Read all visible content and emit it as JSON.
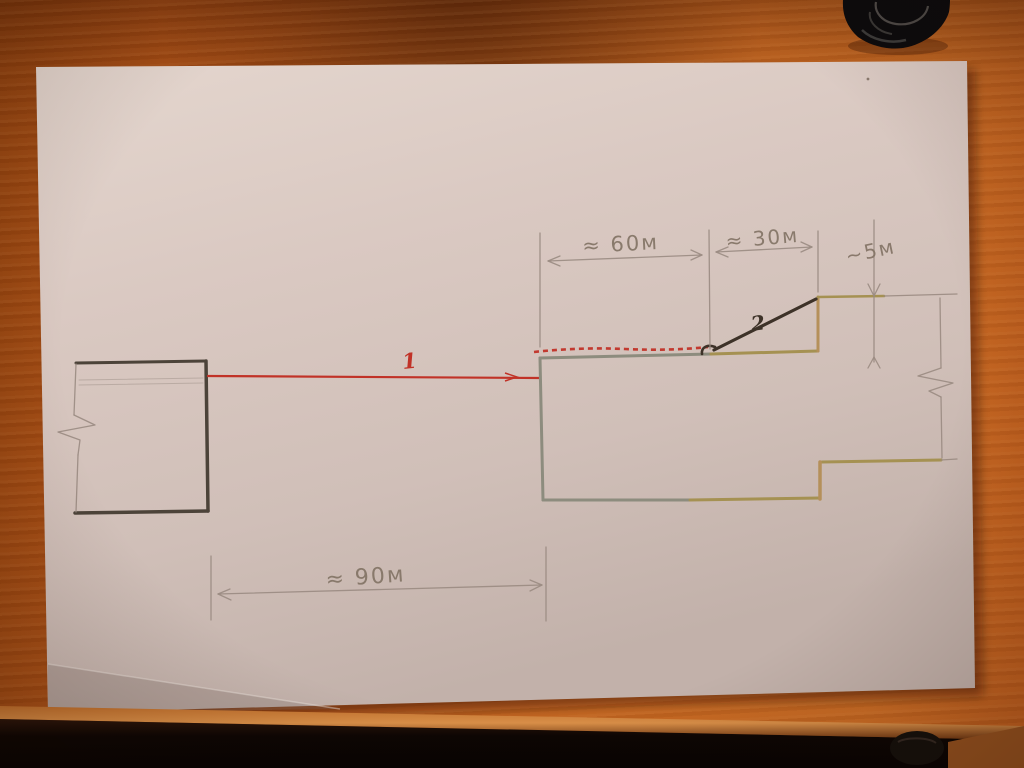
{
  "sketch": {
    "labels": {
      "line1": "1",
      "line2": "2"
    },
    "dimensions": {
      "top_left": "≈ 60м",
      "top_right": "≈ 30м",
      "right_height": "~5м",
      "bottom": "≈ 90м"
    },
    "colors": {
      "red_ink": "#c13227",
      "graphite": "#4c4339",
      "pencil": "#9a8b82",
      "dark_ink": "#3d3228",
      "gray_green_ink": "#8d8c7e",
      "olive_ink": "#a59152",
      "tan_ink": "#b5905a",
      "paper": "#d8c8c1",
      "wood": "#b85a1c"
    }
  }
}
